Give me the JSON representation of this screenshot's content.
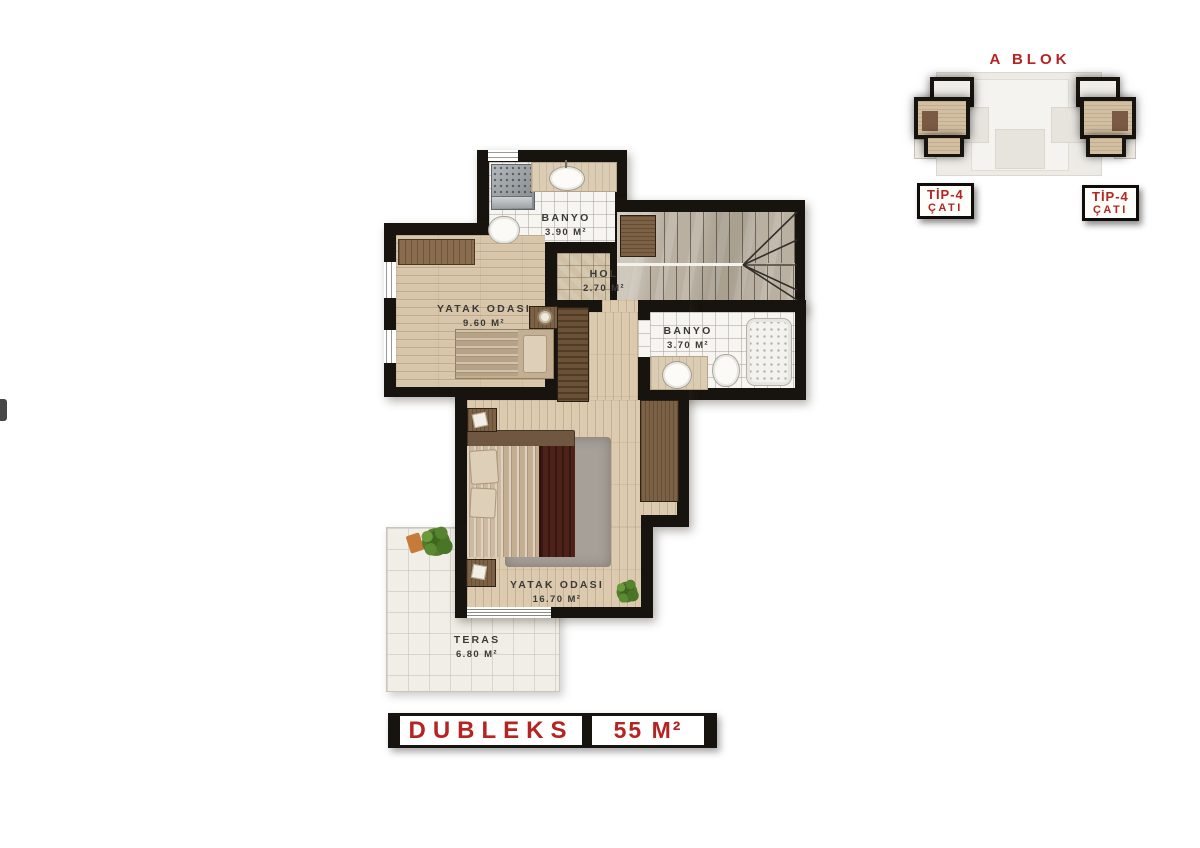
{
  "palette": {
    "accent_red": "#b32422",
    "wall_black": "#17130e",
    "wood_floor": "#d8c6ab",
    "hol_tile": "#cfc0a6",
    "bath_tile": "#f6f5f1",
    "stair_marble": "#b9b0a1",
    "terrace_tile": "#f1eee7"
  },
  "rooms": {
    "banyo_ust": {
      "name": "BANYO",
      "area": "3.90 M²"
    },
    "hol": {
      "name": "HOL",
      "area": "2.70 M²"
    },
    "yatak1": {
      "name": "YATAK ODASI",
      "area": "9.60 M²"
    },
    "banyo_alt": {
      "name": "BANYO",
      "area": "3.70 M²"
    },
    "yatak2": {
      "name": "YATAK ODASI",
      "area": "16.70 M²"
    },
    "teras": {
      "name": "TERAS",
      "area": "6.80 M²"
    }
  },
  "overview": {
    "title": "A BLOK",
    "badges": [
      {
        "line1": "TİP-4",
        "line2": "ÇATI"
      },
      {
        "line1": "TİP-4",
        "line2": "ÇATI"
      }
    ]
  },
  "title_bar": {
    "name": "DUBLEKS",
    "size": "55 M²"
  }
}
